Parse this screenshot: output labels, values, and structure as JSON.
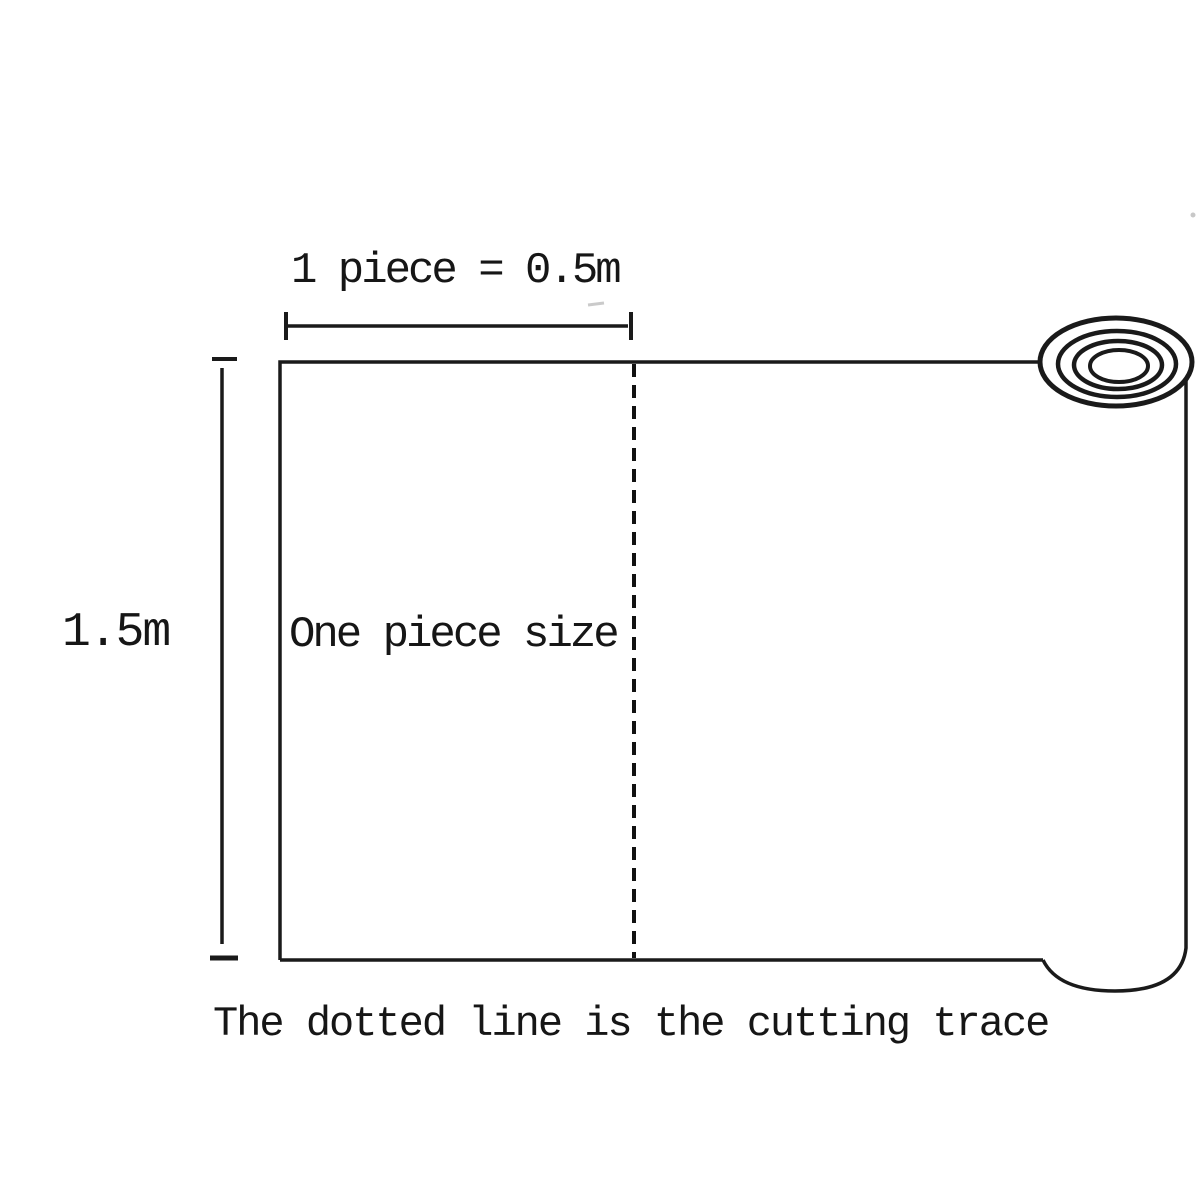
{
  "diagram": {
    "title": "Roll cutting diagram",
    "top_dimension_label": "1 piece = 0.5m",
    "height_dimension_label": "1.5m",
    "piece_label": "One piece size",
    "caption": "The dotted line is the cutting trace",
    "dimensions": {
      "piece_width_m": 0.5,
      "roll_height_m": 1.5
    },
    "colors": {
      "line": "#1a1a1a",
      "text": "#161616",
      "background": "#ffffff"
    }
  }
}
